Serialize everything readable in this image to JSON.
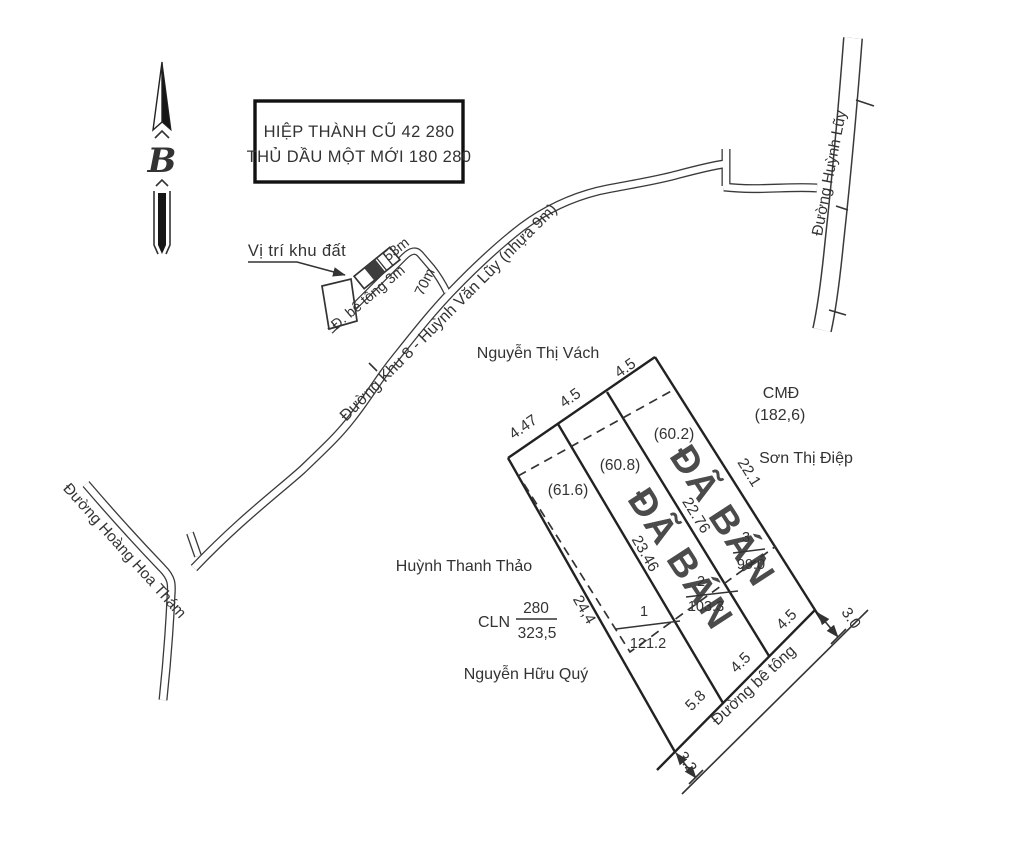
{
  "colors": {
    "ink": "#333333",
    "sold_red": "#d86f6f"
  },
  "north": {
    "label": "B"
  },
  "title_box": {
    "line1": "HIỆP THÀNH CŨ 42 280",
    "line2": "THỦ DẦU MỘT MỚI 180 280"
  },
  "callout": {
    "label": "Vị trí khu đất"
  },
  "roads": {
    "main": "Đường Khu 8 - Huỳnh Văn Lũy (nhựa 9m)",
    "right": "Đường Huỳnh Lũy",
    "left": "Đường Hoàng Hoa Thám",
    "concrete_small": "Đ. bê tông 3m",
    "bottom": "Đường bê tông",
    "frontage_dim": "53m",
    "depth_dim": "70m"
  },
  "parcel": {
    "top_dims": [
      "4.47",
      "4.5",
      "4.5"
    ],
    "edge_left": "24,4",
    "edge_right": "22.1",
    "divider1": "23.46",
    "divider2": "22.76",
    "areas": [
      "(61.6)",
      "(60.8)",
      "(60.2)"
    ],
    "lots": [
      {
        "no": "1",
        "area": "121.2"
      },
      {
        "no": "2",
        "area": "103.3"
      },
      {
        "no": "3",
        "area": "99.0"
      }
    ],
    "bottom_dims": [
      "5.8",
      "4.5",
      "4.5"
    ],
    "road_width_south": "3.2",
    "road_width_east": "3.0",
    "sold_stamp": "ĐÃ BÁN",
    "cmd": {
      "label": "CMĐ",
      "value": "(182,6)"
    },
    "cln": {
      "label": "CLN",
      "num": "280",
      "den": "323,5"
    }
  },
  "neighbors": {
    "north": "Nguyễn Thị Vách",
    "east": "Sơn Thị Điệp",
    "west": "Huỳnh Thanh Thảo",
    "south": "Nguyễn Hữu Quý"
  }
}
